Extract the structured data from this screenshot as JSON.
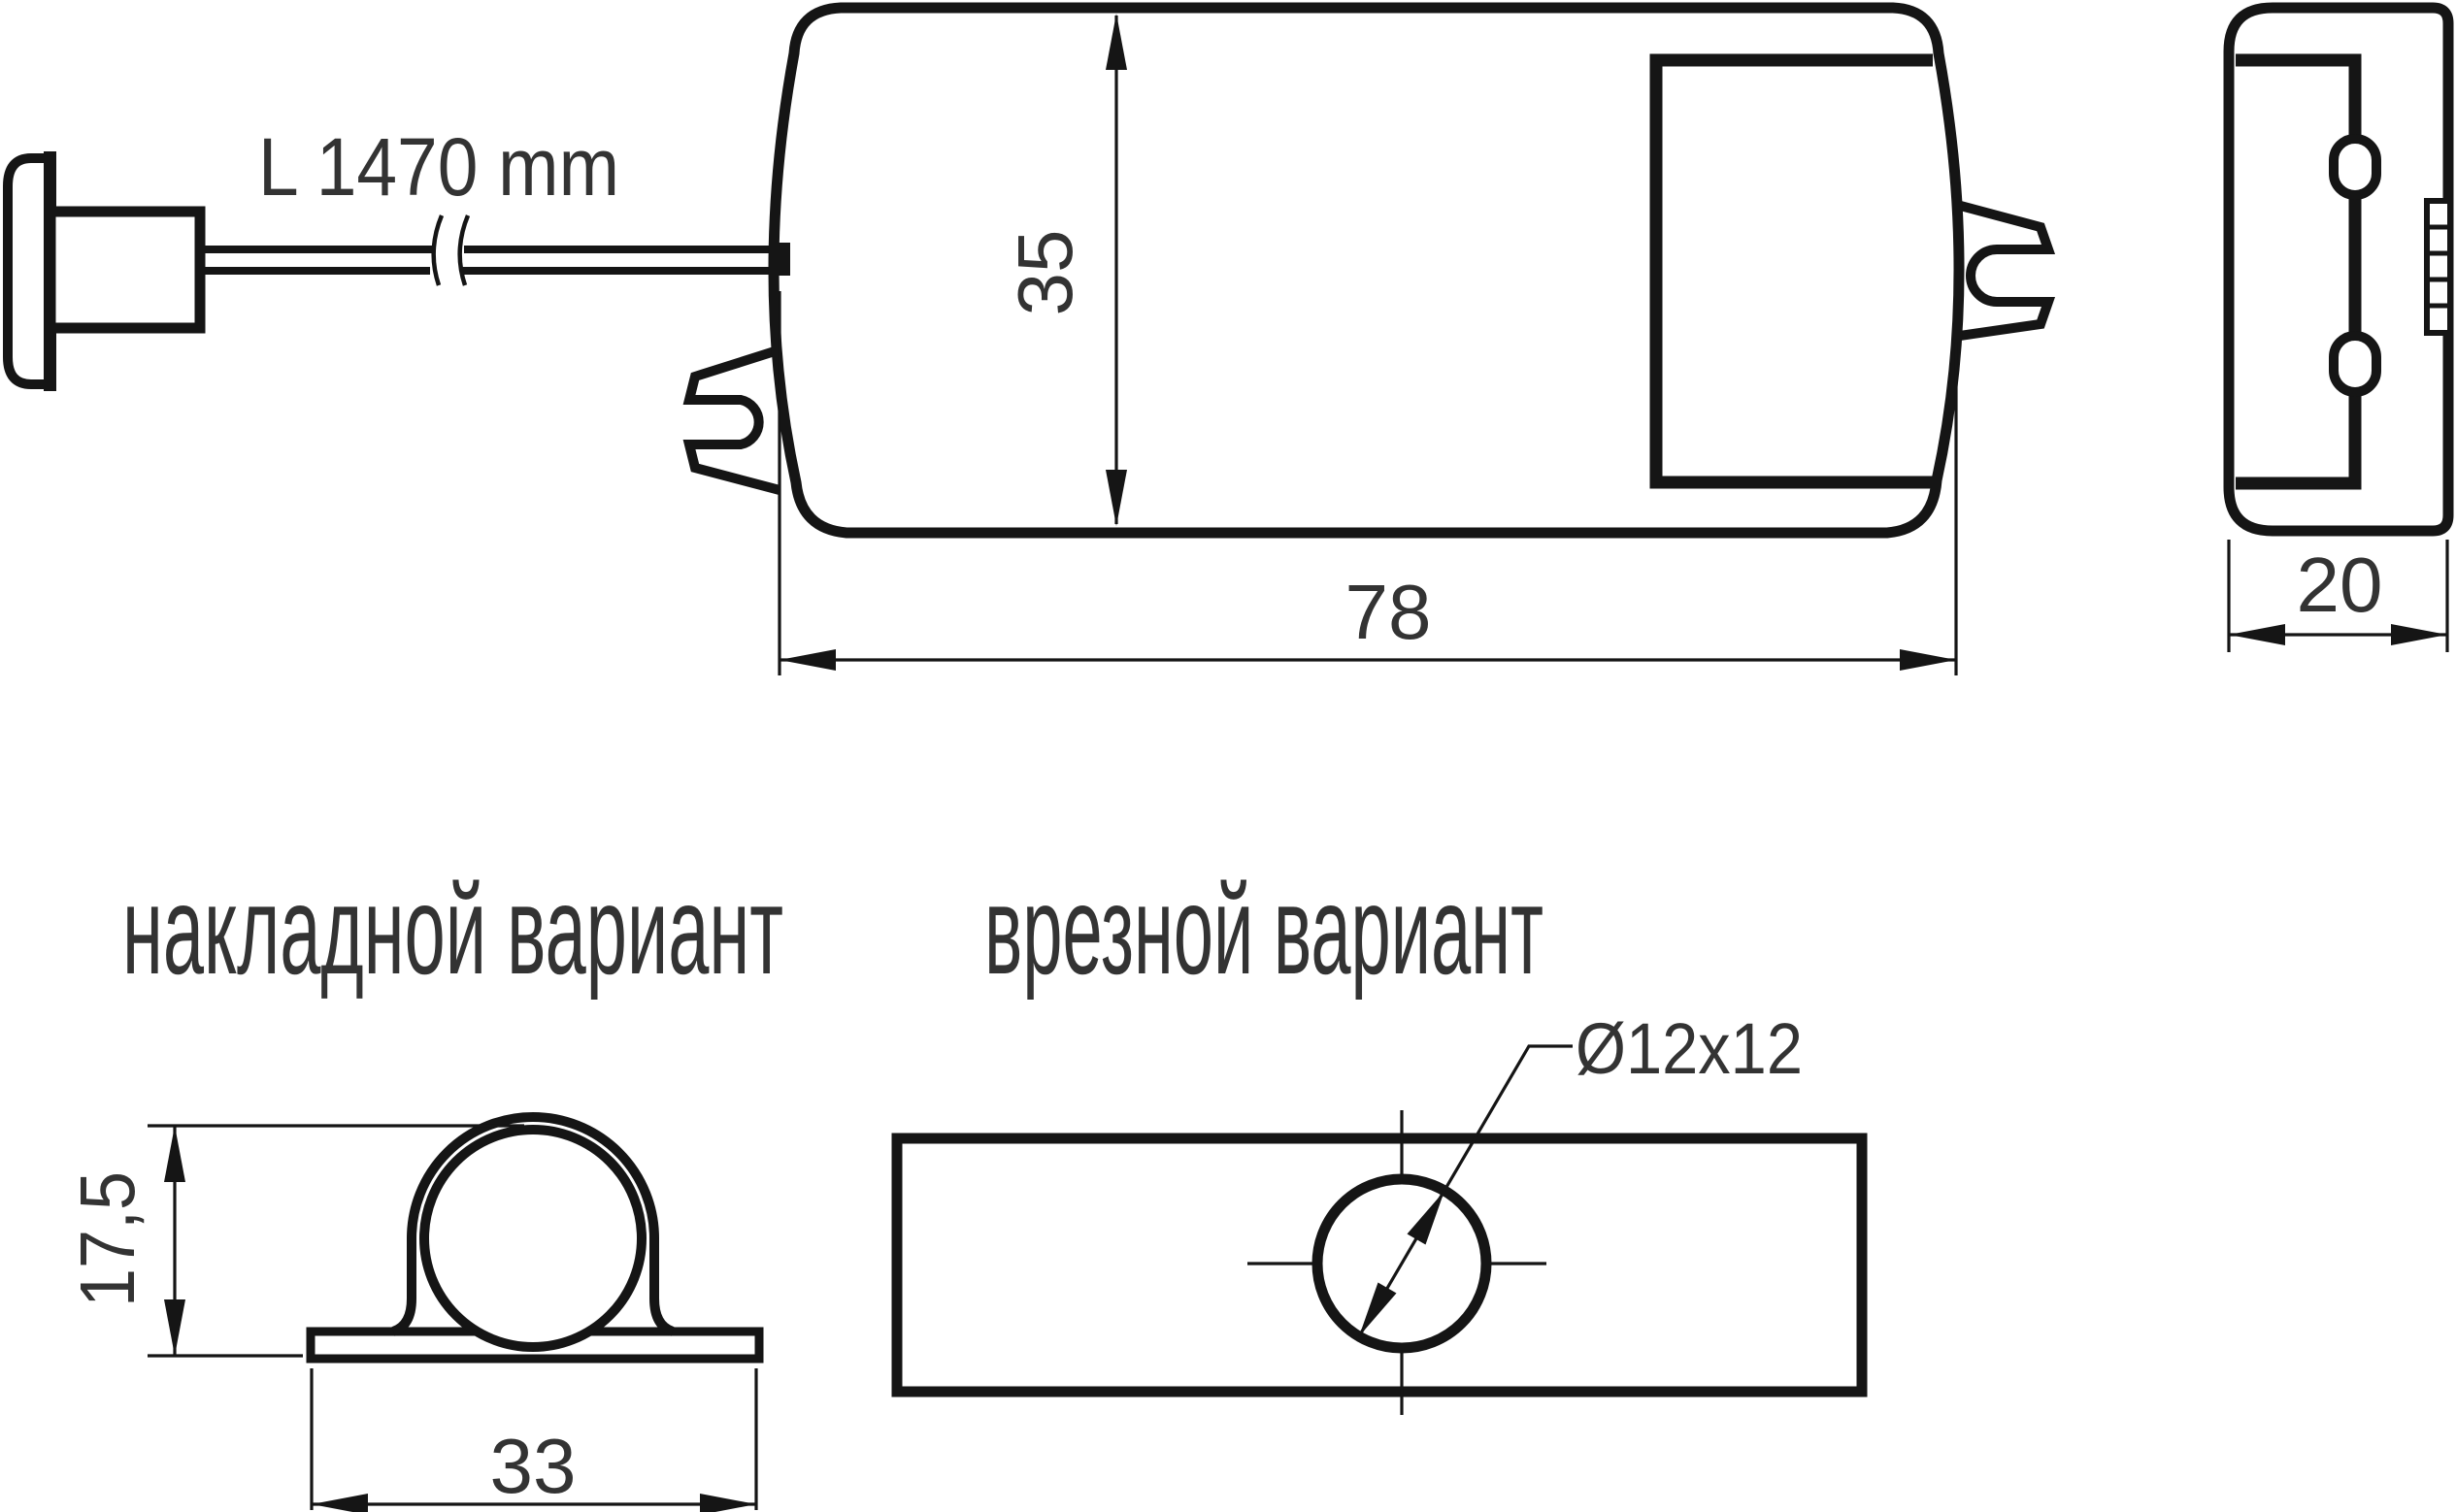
{
  "front_view": {
    "cable_length": "L 1470 mm",
    "height": "35",
    "width": "78"
  },
  "side_view": {
    "depth": "20"
  },
  "variants": {
    "surface": {
      "label": "накладной вариант",
      "clamp_height": "17,5",
      "clamp_width": "33"
    },
    "flush": {
      "label": "врезной вариант",
      "hole": "Ø12x12"
    }
  },
  "colors": {
    "line": "#151515",
    "text": "#333333",
    "background": "#ffffff"
  }
}
